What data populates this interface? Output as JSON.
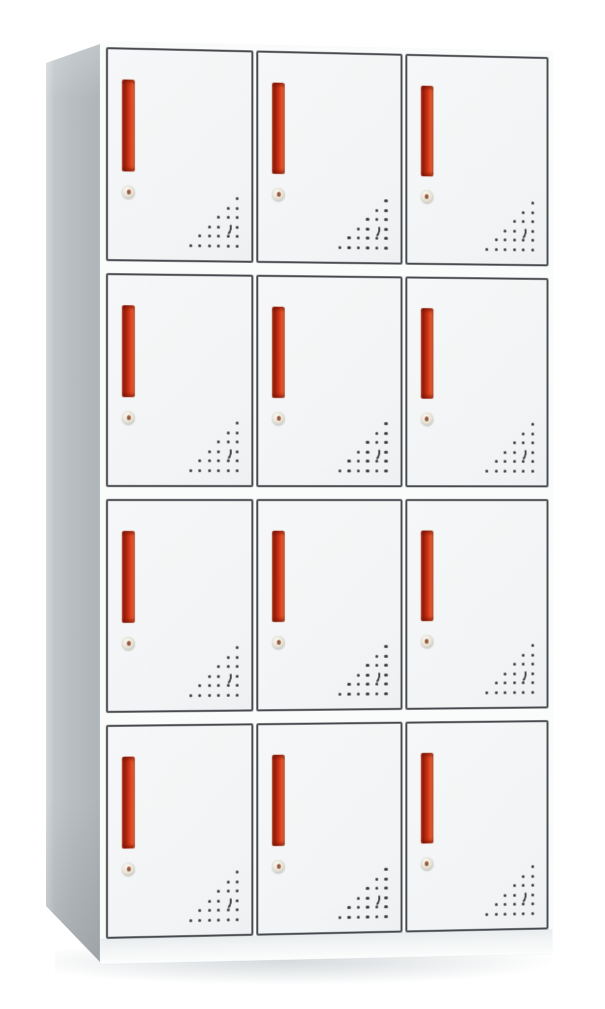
{
  "scene": {
    "subject": "white steel locker cabinet with twelve compartment doors, red vertical handles, round cam locks and triangular ventilation hole patterns",
    "setting": "plain white background product photo"
  },
  "cabinet": {
    "rows": 4,
    "columns": 3,
    "door_count": 12,
    "door": {
      "handle": "vertical-red-bar-handle",
      "lock": "round-cam-lock",
      "vent": {
        "pattern": "right-triangle-dot-grid",
        "rows": 6,
        "spacing_px": 9.5,
        "crescent_row_from_top": 4,
        "crescent_col_from_right": 2
      }
    },
    "colors": {
      "background": "#ffffff",
      "door_face": "#f2f4f5",
      "door_border": "#46494d",
      "side_panel": "#b7bdc1",
      "handle_red": "#cf3416",
      "handle_dark": "#8e1a0a",
      "handle_highlight": "#e9734a",
      "lock_face": "#e7e2d4",
      "vent_dot": "#3b3c3d"
    }
  }
}
